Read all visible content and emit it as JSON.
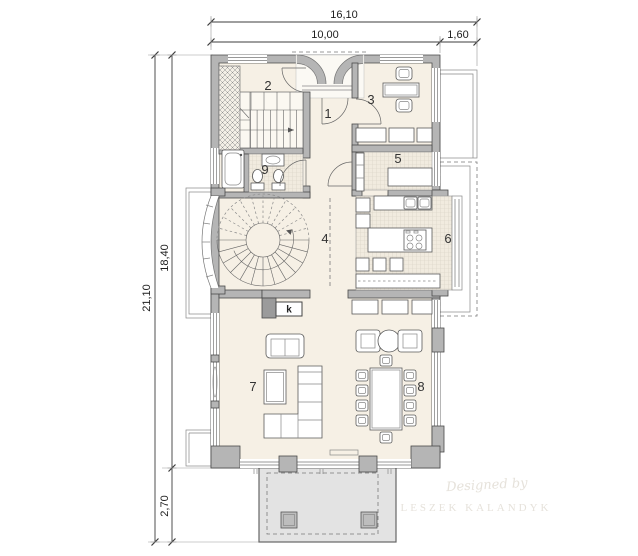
{
  "colors": {
    "wall": "#b5b5b5",
    "wallDark": "#9b9b9b",
    "floor": "#f6f0e5",
    "tileBg": "#f1ebdf",
    "tileLine": "#d5cfc2",
    "terrace": "#e3e3e3",
    "line": "#4a4a4a",
    "furnitureFill": "#fcf9f2",
    "dimension": "#3c3c3c",
    "watermark": "#e6e2db"
  },
  "dimensions": {
    "top_total": "16,10",
    "top_left": "10,00",
    "top_right": "1,60",
    "left_total": "21,10",
    "left_upper": "18,40",
    "left_lower": "2,70"
  },
  "rooms": {
    "r1": "1",
    "r2": "2",
    "r3": "3",
    "r4": "4",
    "r5": "5",
    "r6": "6",
    "r7": "7",
    "r8": "8",
    "r9": "9"
  },
  "fireplace_label": "k",
  "watermark": {
    "line1": "Designed by",
    "line2": "LESZEK KALANDYK"
  }
}
